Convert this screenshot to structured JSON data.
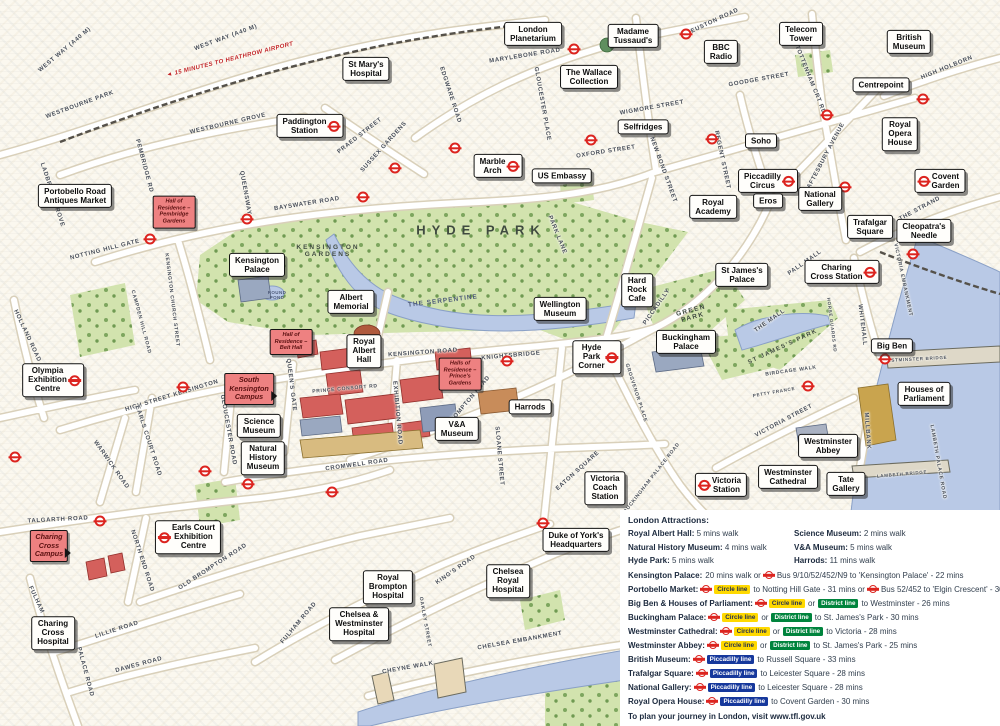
{
  "map": {
    "landmarks": [
      {
        "t": "London\nPlanetarium",
        "x": 533,
        "y": 34
      },
      {
        "t": "Madame\nTussaud's",
        "x": 633,
        "y": 36
      },
      {
        "t": "BBC\nRadio",
        "x": 721,
        "y": 52
      },
      {
        "t": "Telecom\nTower",
        "x": 801,
        "y": 34
      },
      {
        "t": "British\nMuseum",
        "x": 909,
        "y": 42
      },
      {
        "t": "St Mary's\nHospital",
        "x": 366,
        "y": 69
      },
      {
        "t": "Centrepoint",
        "x": 881,
        "y": 85
      },
      {
        "t": "Paddington\nStation",
        "x": 310,
        "y": 126,
        "r": "right"
      },
      {
        "t": "The Wallace\nCollection",
        "x": 589,
        "y": 77
      },
      {
        "t": "Selfridges",
        "x": 643,
        "y": 127
      },
      {
        "t": "Royal\nOpera\nHouse",
        "x": 900,
        "y": 134
      },
      {
        "t": "Soho",
        "x": 761,
        "y": 141
      },
      {
        "t": "Marble\nArch",
        "x": 498,
        "y": 166,
        "r": "right"
      },
      {
        "t": "US Embassy",
        "x": 562,
        "y": 176
      },
      {
        "t": "Piccadilly\nCircus",
        "x": 768,
        "y": 181,
        "r": "right"
      },
      {
        "t": "Eros",
        "x": 768,
        "y": 201
      },
      {
        "t": "National\nGallery",
        "x": 820,
        "y": 199
      },
      {
        "t": "Covent\nGarden",
        "x": 940,
        "y": 181,
        "r": "left"
      },
      {
        "t": "Trafalgar\nSquare",
        "x": 870,
        "y": 227
      },
      {
        "t": "Cleopatra's\nNeedle",
        "x": 924,
        "y": 231
      },
      {
        "t": "Royal\nAcademy",
        "x": 713,
        "y": 207
      },
      {
        "t": "Portobello Road\nAntiques Market",
        "x": 75,
        "y": 196
      },
      {
        "t": "Kensington\nPalace",
        "x": 257,
        "y": 265
      },
      {
        "t": "Albert\nMemorial",
        "x": 351,
        "y": 302
      },
      {
        "t": "Wellington\nMuseum",
        "x": 560,
        "y": 309
      },
      {
        "t": "Hard\nRock\nCafe",
        "x": 637,
        "y": 290
      },
      {
        "t": "St James's\nPalace",
        "x": 742,
        "y": 275
      },
      {
        "t": "Charing\nCross Station",
        "x": 842,
        "y": 272,
        "r": "right"
      },
      {
        "t": "Buckingham\nPalace",
        "x": 686,
        "y": 342
      },
      {
        "t": "Hyde\nPark\nCorner",
        "x": 597,
        "y": 357,
        "r": "right"
      },
      {
        "t": "Big Ben",
        "x": 892,
        "y": 346
      },
      {
        "t": "Houses of\nParliament",
        "x": 924,
        "y": 394
      },
      {
        "t": "Royal\nAlbert\nHall",
        "x": 364,
        "y": 351
      },
      {
        "t": "Science\nMuseum",
        "x": 259,
        "y": 426
      },
      {
        "t": "Natural\nHistory\nMuseum",
        "x": 263,
        "y": 458
      },
      {
        "t": "V&A\nMuseum",
        "x": 457,
        "y": 429
      },
      {
        "t": "Harrods",
        "x": 530,
        "y": 407
      },
      {
        "t": "Westminster\nAbbey",
        "x": 828,
        "y": 446
      },
      {
        "t": "Westminster\nCathedral",
        "x": 788,
        "y": 477
      },
      {
        "t": "Victoria\nStation",
        "x": 721,
        "y": 485,
        "r": "left"
      },
      {
        "t": "Tate\nGallery",
        "x": 846,
        "y": 484
      },
      {
        "t": "Victoria\nCoach\nStation",
        "x": 605,
        "y": 488
      },
      {
        "t": "Earls Court\nExhibition\nCentre",
        "x": 188,
        "y": 537,
        "r": "left"
      },
      {
        "t": "Duke of York's\nHeadquarters",
        "x": 576,
        "y": 540
      },
      {
        "t": "Charing\nCross\nHospital",
        "x": 53,
        "y": 633
      },
      {
        "t": "Royal\nBrompton\nHospital",
        "x": 388,
        "y": 587
      },
      {
        "t": "Chelsea\nRoyal\nHospital",
        "x": 508,
        "y": 581
      },
      {
        "t": "Chelsea &\nWestminster\nHospital",
        "x": 359,
        "y": 624
      },
      {
        "t": "Olympia\nExhibition\nCentre",
        "x": 53,
        "y": 380,
        "r": "right"
      }
    ],
    "campus_labels": [
      {
        "t": "Hall of\nResidence –\nPembridge\nGardens",
        "x": 174,
        "y": 212,
        "k": "hall"
      },
      {
        "t": "Hall of\nResidence –\nBeit Hall",
        "x": 291,
        "y": 342,
        "k": "hall"
      },
      {
        "t": "Halls of\nResidence –\nPrince's\nGardens",
        "x": 460,
        "y": 374,
        "k": "hall"
      },
      {
        "t": "South\nKensington\nCampus",
        "x": 249,
        "y": 389,
        "k": "campus"
      },
      {
        "t": "Charing\nCross\nCampus",
        "x": 49,
        "y": 546,
        "k": "campus"
      }
    ],
    "area_labels": [
      {
        "t": "HYDE PARK",
        "x": 481,
        "y": 230,
        "rot": 0,
        "fs": 13,
        "ls": 6,
        "c": "#3f4a40"
      },
      {
        "t": "KENSINGTON\nGARDENS",
        "x": 328,
        "y": 251,
        "rot": 0,
        "fs": 6.5,
        "ls": 2,
        "c": "#3f4a40"
      },
      {
        "t": "GREEN\nPARK",
        "x": 692,
        "y": 314,
        "rot": -15,
        "fs": 6.5,
        "ls": 1.5,
        "c": "#3f4a40"
      },
      {
        "t": "ST JAMES'S PARK",
        "x": 783,
        "y": 347,
        "rot": -25,
        "fs": 6,
        "ls": 1.5,
        "c": "#3f4a40"
      },
      {
        "t": "THE SERPENTINE",
        "x": 443,
        "y": 301,
        "rot": -7,
        "fs": 6.5,
        "ls": 1,
        "c": "#4d5a78"
      },
      {
        "t": "ROUND\nPOND",
        "x": 277,
        "y": 295,
        "rot": 0,
        "fs": 4.5,
        "ls": 0.4,
        "c": "#4d5a78"
      }
    ],
    "road_labels": [
      {
        "t": "WEST WAY (A40 M)",
        "x": 65,
        "y": 50,
        "rot": -40
      },
      {
        "t": "WEST WAY (A40 M)",
        "x": 226,
        "y": 38,
        "rot": -20
      },
      {
        "t": "WESTBOURNE PARK",
        "x": 80,
        "y": 105,
        "rot": -20
      },
      {
        "t": "WESTBOURNE GROVE",
        "x": 228,
        "y": 124,
        "rot": -13
      },
      {
        "t": "LADBROKE GROVE",
        "x": 52,
        "y": 195,
        "rot": 72
      },
      {
        "t": "PEMBRIDGE RD",
        "x": 144,
        "y": 166,
        "rot": 75
      },
      {
        "t": "QUEENSWAY",
        "x": 245,
        "y": 193,
        "rot": 80
      },
      {
        "t": "BAYSWATER ROAD",
        "x": 307,
        "y": 204,
        "rot": -9
      },
      {
        "t": "PRAED STREET",
        "x": 360,
        "y": 136,
        "rot": -38
      },
      {
        "t": "SUSSEX GARDENS",
        "x": 384,
        "y": 147,
        "rot": -48
      },
      {
        "t": "EDGWARE ROAD",
        "x": 450,
        "y": 95,
        "rot": 72
      },
      {
        "t": "GLOUCESTER PLACE",
        "x": 542,
        "y": 104,
        "rot": 80
      },
      {
        "t": "MARYLEBONE ROAD",
        "x": 525,
        "y": 56,
        "rot": -9
      },
      {
        "t": "EUSTON ROAD",
        "x": 715,
        "y": 21,
        "rot": -25
      },
      {
        "t": "WIGMORE STREET",
        "x": 652,
        "y": 108,
        "rot": -10
      },
      {
        "t": "OXFORD STREET",
        "x": 606,
        "y": 152,
        "rot": -9
      },
      {
        "t": "NEW BOND STREET",
        "x": 663,
        "y": 170,
        "rot": 70
      },
      {
        "t": "REGENT STREET",
        "x": 722,
        "y": 160,
        "rot": 78
      },
      {
        "t": "GOODGE STREET",
        "x": 759,
        "y": 80,
        "rot": -10
      },
      {
        "t": "TOTTENHAM CRT RD",
        "x": 810,
        "y": 80,
        "rot": 68
      },
      {
        "t": "HIGH HOLBORN",
        "x": 947,
        "y": 68,
        "rot": -22
      },
      {
        "t": "SHAFTESBURY AVENUE",
        "x": 824,
        "y": 160,
        "rot": -62
      },
      {
        "t": "THE STRAND",
        "x": 920,
        "y": 209,
        "rot": -28
      },
      {
        "t": "PARK LANE",
        "x": 557,
        "y": 235,
        "rot": 68
      },
      {
        "t": "PICCADILLY",
        "x": 657,
        "y": 307,
        "rot": -55
      },
      {
        "t": "PALL MALL",
        "x": 805,
        "y": 263,
        "rot": -35
      },
      {
        "t": "THE MALL",
        "x": 770,
        "y": 321,
        "rot": -35
      },
      {
        "t": "WHITEHALL",
        "x": 862,
        "y": 325,
        "rot": 83
      },
      {
        "t": "HORSE GUARDS RD",
        "x": 832,
        "y": 325,
        "rot": 83,
        "fs": 4.5
      },
      {
        "t": "BIRDCAGE WALK",
        "x": 791,
        "y": 371,
        "rot": -8,
        "fs": 5
      },
      {
        "t": "PETTY FRANCE",
        "x": 774,
        "y": 392,
        "rot": -10,
        "fs": 4.5
      },
      {
        "t": "VICTORIA STREET",
        "x": 784,
        "y": 421,
        "rot": -28
      },
      {
        "t": "MILLBANK",
        "x": 867,
        "y": 431,
        "rot": 86
      },
      {
        "t": "VICTORIA EMBANKMENT",
        "x": 903,
        "y": 280,
        "rot": 78,
        "fs": 5
      },
      {
        "t": "WESTMINSTER BRIDGE",
        "x": 915,
        "y": 359,
        "rot": -3,
        "fs": 4.5
      },
      {
        "t": "LAMBETH BRIDGE",
        "x": 902,
        "y": 474,
        "rot": -5,
        "fs": 4.5
      },
      {
        "t": "LAMBETH PALACE ROAD",
        "x": 938,
        "y": 462,
        "rot": 80,
        "fs": 5
      },
      {
        "t": "KNIGHTSBRIDGE",
        "x": 511,
        "y": 356,
        "rot": -5
      },
      {
        "t": "KENSINGTON ROAD",
        "x": 423,
        "y": 353,
        "rot": -4
      },
      {
        "t": "PRINCE CONSORT RD",
        "x": 345,
        "y": 389,
        "rot": -5,
        "fs": 5
      },
      {
        "t": "QUEEN'S GATE",
        "x": 291,
        "y": 385,
        "rot": 83
      },
      {
        "t": "EXHIBITION ROAD",
        "x": 397,
        "y": 413,
        "rot": 85
      },
      {
        "t": "GLOUCESTER ROAD",
        "x": 228,
        "y": 430,
        "rot": 80
      },
      {
        "t": "CROMWELL ROAD",
        "x": 357,
        "y": 465,
        "rot": -8
      },
      {
        "t": "BROMPTON ROAD",
        "x": 469,
        "y": 401,
        "rot": -50
      },
      {
        "t": "SLOANE STREET",
        "x": 499,
        "y": 456,
        "rot": 85
      },
      {
        "t": "EATON SQUARE",
        "x": 578,
        "y": 471,
        "rot": -42
      },
      {
        "t": "BUCKINGHAM PALACE ROAD",
        "x": 652,
        "y": 478,
        "rot": -52,
        "fs": 5
      },
      {
        "t": "GROSVENOR PLACE",
        "x": 636,
        "y": 393,
        "rot": 72,
        "fs": 5
      },
      {
        "t": "NOTTING HILL GATE",
        "x": 105,
        "y": 250,
        "rot": -14
      },
      {
        "t": "KENSINGTON CHURCH STREET",
        "x": 172,
        "y": 300,
        "rot": 83,
        "fs": 5
      },
      {
        "t": "CAMPDEN HILL ROAD",
        "x": 141,
        "y": 322,
        "rot": 75,
        "fs": 5
      },
      {
        "t": "HOLLAND ROAD",
        "x": 27,
        "y": 336,
        "rot": 65
      },
      {
        "t": "HIGH STREET KENSINGTON",
        "x": 172,
        "y": 396,
        "rot": -17
      },
      {
        "t": "EARLS COURT ROAD",
        "x": 148,
        "y": 441,
        "rot": 72
      },
      {
        "t": "WARWICK ROAD",
        "x": 111,
        "y": 465,
        "rot": 55
      },
      {
        "t": "TALGARTH ROAD",
        "x": 58,
        "y": 520,
        "rot": -3
      },
      {
        "t": "NORTH END ROAD",
        "x": 142,
        "y": 561,
        "rot": 72
      },
      {
        "t": "OLD BROMPTON ROAD",
        "x": 213,
        "y": 567,
        "rot": -33
      },
      {
        "t": "LILLIE ROAD",
        "x": 117,
        "y": 630,
        "rot": -18
      },
      {
        "t": "DAWES ROAD",
        "x": 139,
        "y": 665,
        "rot": -15
      },
      {
        "t": "FULHAM",
        "x": 36,
        "y": 600,
        "rot": 65
      },
      {
        "t": "PALACE ROAD",
        "x": 85,
        "y": 672,
        "rot": 75
      },
      {
        "t": "FULHAM ROAD",
        "x": 299,
        "y": 623,
        "rot": -50
      },
      {
        "t": "KING'S ROAD",
        "x": 456,
        "y": 570,
        "rot": -35
      },
      {
        "t": "OAKLEY STREET",
        "x": 425,
        "y": 622,
        "rot": 80,
        "fs": 5
      },
      {
        "t": "CHEYNE WALK",
        "x": 408,
        "y": 668,
        "rot": -10
      },
      {
        "t": "CHELSEA EMBANKMENT",
        "x": 520,
        "y": 641,
        "rot": -10
      }
    ],
    "heathrow_note": {
      "t": "15 MINUTES TO HEATHROW AIRPORT",
      "x": 230,
      "y": 60,
      "rot": -14
    },
    "roundels": [
      [
        150,
        239
      ],
      [
        247,
        219
      ],
      [
        363,
        197
      ],
      [
        395,
        168
      ],
      [
        455,
        148
      ],
      [
        574,
        49
      ],
      [
        686,
        34
      ],
      [
        712,
        139
      ],
      [
        591,
        140
      ],
      [
        827,
        115
      ],
      [
        923,
        99
      ],
      [
        845,
        187
      ],
      [
        507,
        361
      ],
      [
        543,
        523
      ],
      [
        808,
        386
      ],
      [
        885,
        359
      ],
      [
        913,
        254
      ],
      [
        183,
        387
      ],
      [
        15,
        457
      ],
      [
        100,
        521
      ],
      [
        205,
        471
      ],
      [
        332,
        492
      ],
      [
        248,
        484
      ]
    ]
  },
  "legend": {
    "header": "London Attractions:",
    "walk_rows": [
      {
        "n1": "Royal Albert Hall:",
        "v1": "5 mins walk",
        "n2": "Science Museum:",
        "v2": "2 mins walk"
      },
      {
        "n1": "Natural History Museum:",
        "v1": "4 mins walk",
        "n2": "V&A Museum:",
        "v2": "5 mins walk"
      },
      {
        "n1": "Hyde Park:",
        "v1": "5 mins walk",
        "n2": "Harrods:",
        "v2": "11 mins walk"
      }
    ],
    "transit_rows": [
      {
        "n": "Kensington Palace:",
        "p": [
          [
            "t",
            "20 mins walk or"
          ],
          [
            "r"
          ],
          [
            "t",
            "Bus 9/10/52/452/N9 to 'Kensington Palace' - 22 mins"
          ]
        ]
      },
      {
        "n": "Portobello Market:",
        "p": [
          [
            "r"
          ],
          [
            "b",
            "circle",
            "Circle line"
          ],
          [
            "t",
            "to Notting Hill Gate - 31 mins or"
          ],
          [
            "r"
          ],
          [
            "t",
            "Bus 52/452 to 'Elgin Crescent' - 30 mins"
          ]
        ]
      },
      {
        "n": "Big Ben & Houses of Parliament:",
        "p": [
          [
            "r"
          ],
          [
            "b",
            "circle",
            "Circle line"
          ],
          [
            "t",
            "or"
          ],
          [
            "b",
            "district",
            "District line"
          ],
          [
            "t",
            "to Westminster - 26 mins"
          ]
        ]
      },
      {
        "n": "Buckingham Palace:",
        "p": [
          [
            "r"
          ],
          [
            "b",
            "circle",
            "Circle line"
          ],
          [
            "t",
            "or"
          ],
          [
            "b",
            "district",
            "District line"
          ],
          [
            "t",
            "to St. James's Park - 30 mins"
          ]
        ]
      },
      {
        "n": "Westminster Cathedral:",
        "p": [
          [
            "r"
          ],
          [
            "b",
            "circle",
            "Circle line"
          ],
          [
            "t",
            "or"
          ],
          [
            "b",
            "district",
            "District line"
          ],
          [
            "t",
            "to Victoria - 28 mins"
          ]
        ]
      },
      {
        "n": "Westminster Abbey:",
        "p": [
          [
            "r"
          ],
          [
            "b",
            "circle",
            "Circle line"
          ],
          [
            "t",
            "or"
          ],
          [
            "b",
            "district",
            "District line"
          ],
          [
            "t",
            "to St. James's Park - 25 mins"
          ]
        ]
      },
      {
        "n": "British Museum:",
        "p": [
          [
            "r"
          ],
          [
            "b",
            "piccadilly",
            "Piccadilly line"
          ],
          [
            "t",
            "to Russell Square - 33 mins"
          ]
        ]
      },
      {
        "n": "Trafalgar Square:",
        "p": [
          [
            "r"
          ],
          [
            "b",
            "piccadilly",
            "Piccadilly line"
          ],
          [
            "t",
            "to Leicester Square - 28 mins"
          ]
        ]
      },
      {
        "n": "National Gallery:",
        "p": [
          [
            "r"
          ],
          [
            "b",
            "piccadilly",
            "Piccadilly line"
          ],
          [
            "t",
            "to Leicester Square - 28 mins"
          ]
        ]
      },
      {
        "n": "Royal Opera House:",
        "p": [
          [
            "r"
          ],
          [
            "b",
            "piccadilly",
            "Piccadilly line"
          ],
          [
            "t",
            "to Covent Garden - 30 mins"
          ]
        ]
      }
    ],
    "footer_text": "To plan your journey in London, visit",
    "footer_link": "www.tfl.gov.uk"
  },
  "colors": {
    "roundel_red": "#dc241f",
    "circle_line": "#ffd900",
    "district_line": "#00843d",
    "piccadilly_line": "#16389c",
    "campus_pink": "#ee8181",
    "park_green": "#d2e3ae",
    "water_blue": "#b9c9e6"
  }
}
